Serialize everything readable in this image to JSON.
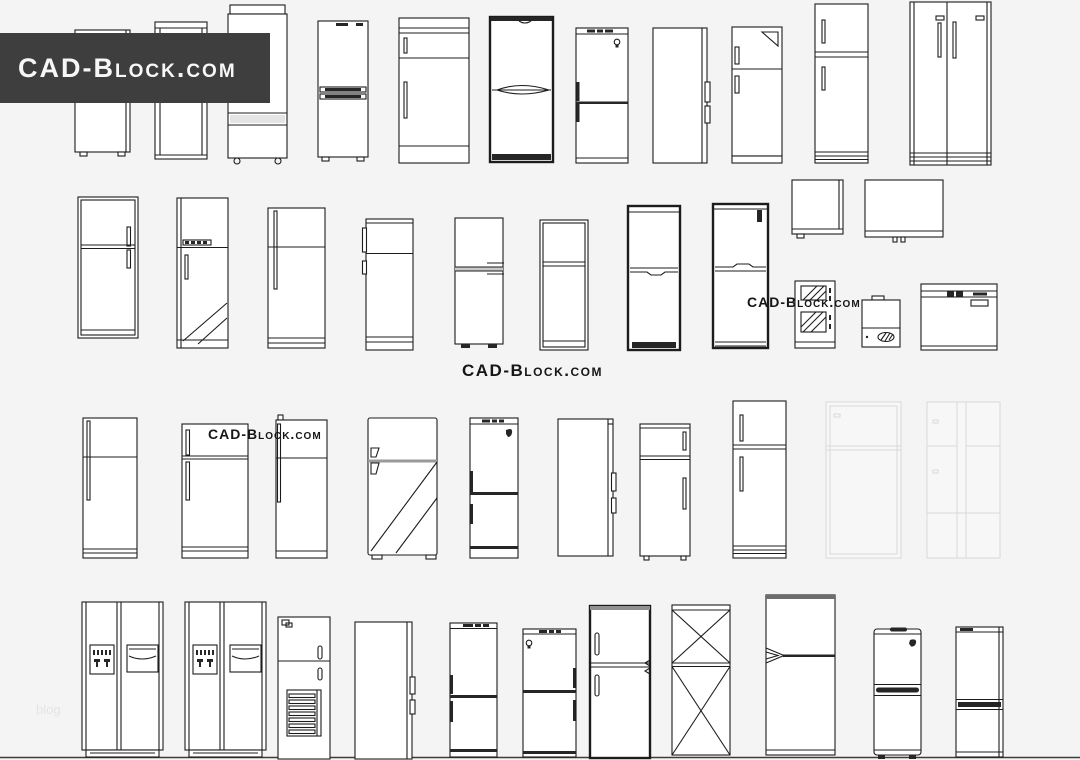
{
  "banner": {
    "label": "CAD-Block.com",
    "bg_color": "#3e3e3e",
    "text_color": "#f7f7f7"
  },
  "watermarks": [
    {
      "id": "center",
      "text": "CAD-Block.com"
    },
    {
      "id": "row2-right",
      "text": "CAD-Block.com"
    },
    {
      "id": "row3-left",
      "text": "CAD-Block.com"
    }
  ],
  "footer": {
    "blog_label": "blog"
  },
  "canvas": {
    "width": 1080,
    "height": 760,
    "background": "#f4f4f4",
    "line_color": "#1c1c1c",
    "ground_line_color": "#3c3c3c"
  },
  "drawings": {
    "description": "CAD line drawings of refrigerators and freezers, front and side elevations, 4 rows",
    "items": [
      "single-door-mini-fridge",
      "tall-narrow-fridge",
      "three-door-fridge-casters",
      "bottom-freezer-double-handle",
      "single-door-band-fridge",
      "dark-outline-curved-fridge",
      "grille-top-bulb-fridge",
      "side-view-panel",
      "top-freezer-folded-corner",
      "top-freezer-striped-base",
      "side-by-side-double-door",
      "double-border-top-freezer",
      "diagonal-door-fridge",
      "long-handle-top-freezer",
      "left-tab-handle-fridge",
      "gray-divider-fridge",
      "double-frame-fridge",
      "thick-notch-divider-fridge",
      "thick-tall-fridge",
      "mini-box-fridge",
      "wide-box-fridge",
      "hatched-panel-unit",
      "compressor-unit",
      "chest-freezer",
      "long-handle-fridge-a",
      "two-handle-top-freezer",
      "long-handle-fridge-b",
      "open-door-diagonal-fridge",
      "grille-bird-bottom-freezer",
      "side-view-hinged",
      "top-freezer-with-feet",
      "striped-base-top-freezer",
      "faint-top-freezer",
      "faint-four-door",
      "side-by-side-dispenser-a",
      "side-by-side-dispenser-b",
      "louver-grille-fridge",
      "side-view-tall",
      "grille-left-handle-bottom-freezer",
      "grille-bulb-bottom-freezer",
      "two-box-thick-fridge",
      "x-brace-fridge",
      "arrow-handle-fridge",
      "curved-band-fridge",
      "dark-band-bottom-freezer"
    ]
  }
}
